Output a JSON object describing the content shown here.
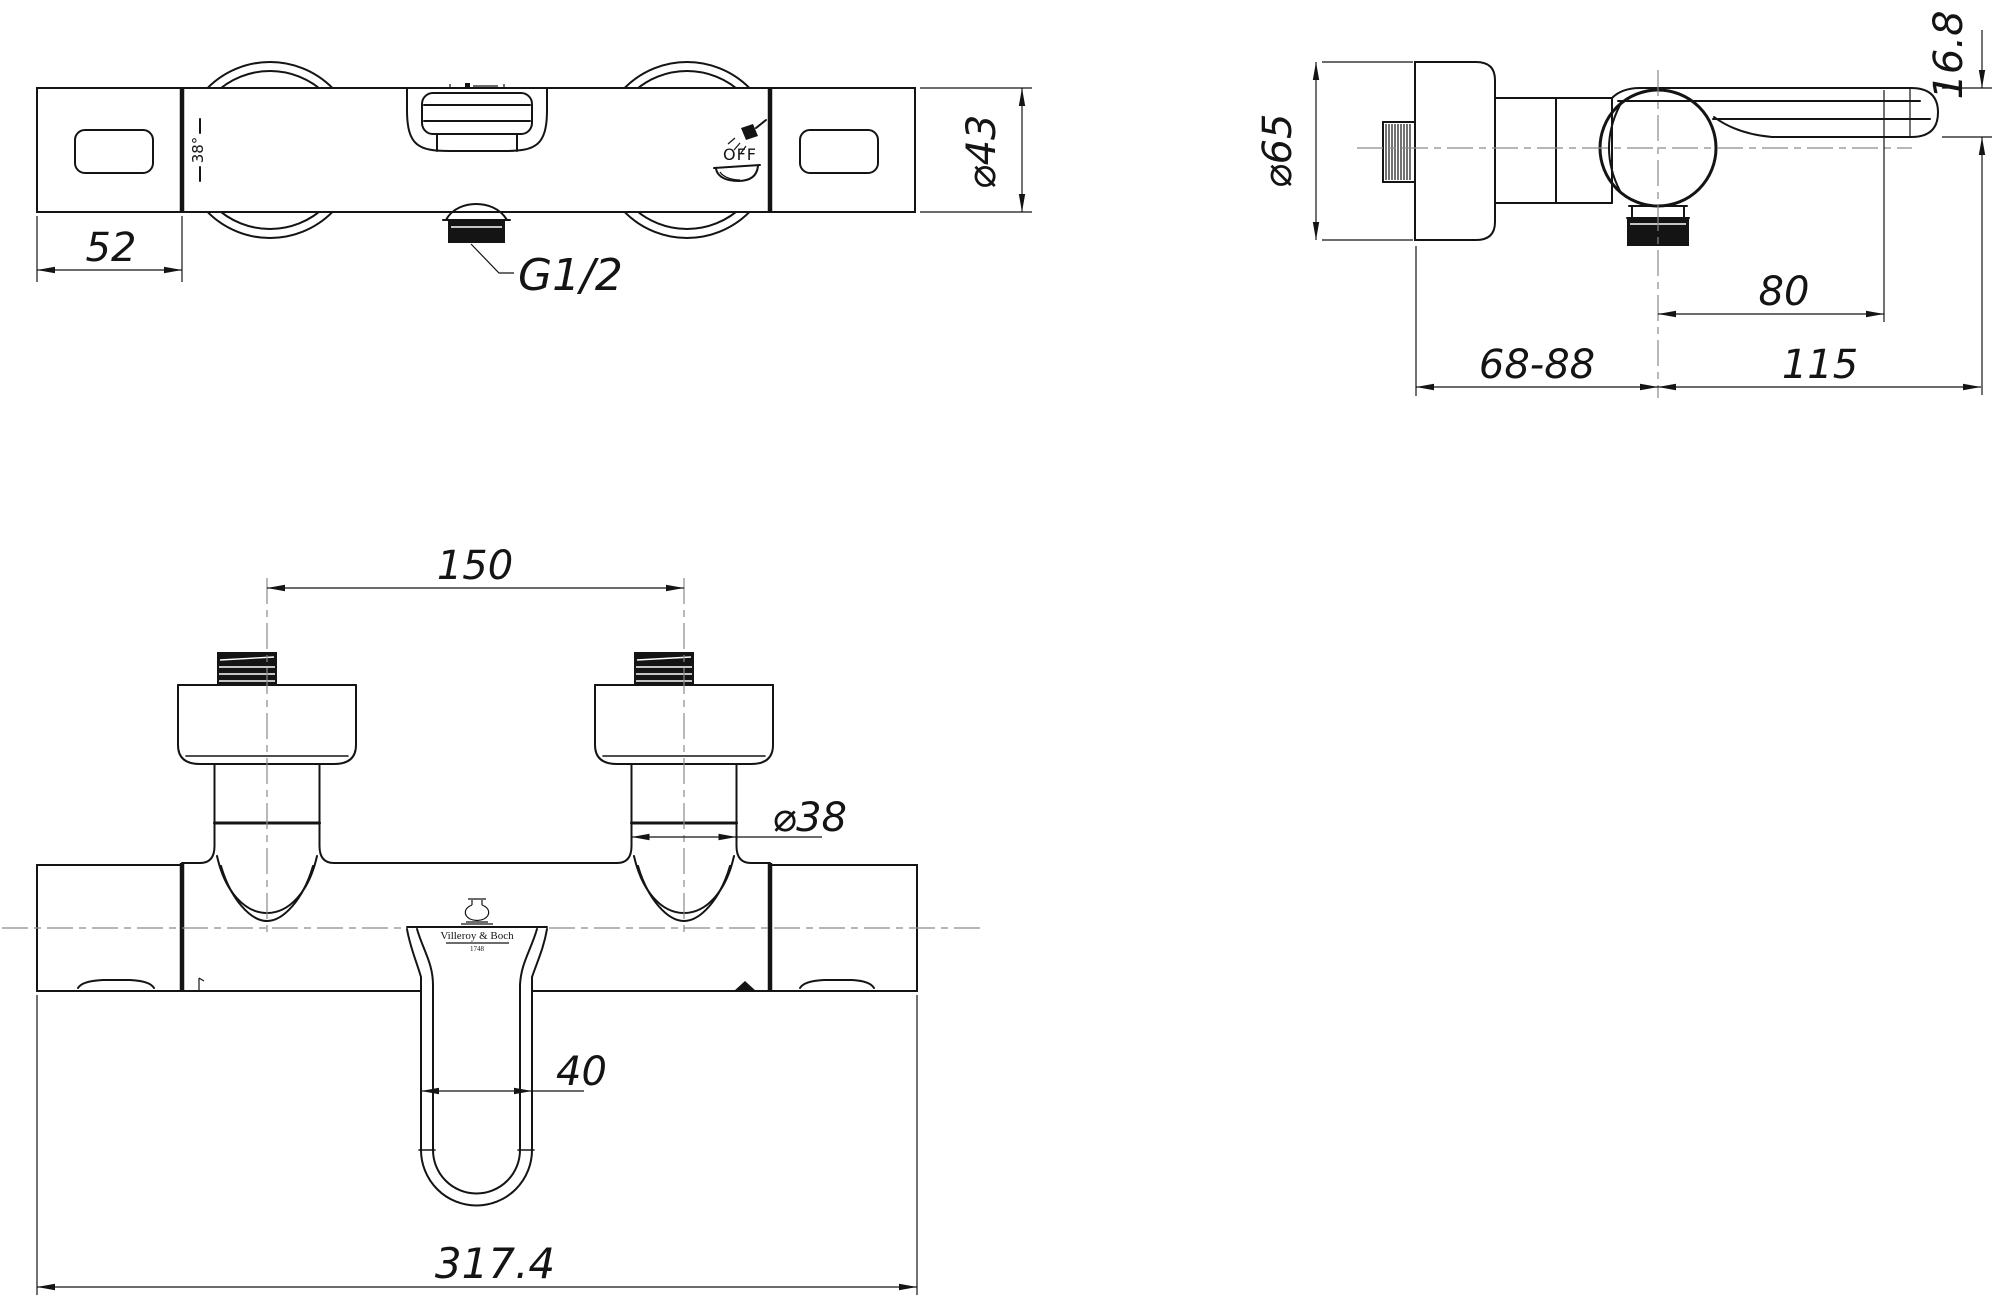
{
  "page": {
    "background": "#ffffff",
    "line_color": "#141414",
    "centerline_color": "#8a8a8a"
  },
  "brand": {
    "name": "Villeroy & Boch",
    "founded": "1748"
  },
  "views": {
    "top": {
      "dim_handle_width": "52",
      "dim_body_diameter": "⌀43",
      "thread_label": "G1/2",
      "temp_marking": "38°",
      "off_marking": "OFF"
    },
    "side": {
      "dim_escutcheon_diameter": "⌀65",
      "dim_lever_thickness": "16.8",
      "dim_outlet_offset": "80",
      "dim_wall_distance": "68-88",
      "dim_reach": "115"
    },
    "front": {
      "dim_inlet_centers": "150",
      "dim_pipe_diameter": "⌀38",
      "dim_spout_width": "40",
      "dim_overall_width": "317.4"
    }
  },
  "icons": {
    "shower": "shower-icon",
    "bathtub": "bathtub-icon",
    "brand_logo": "amphora-logo-icon"
  }
}
